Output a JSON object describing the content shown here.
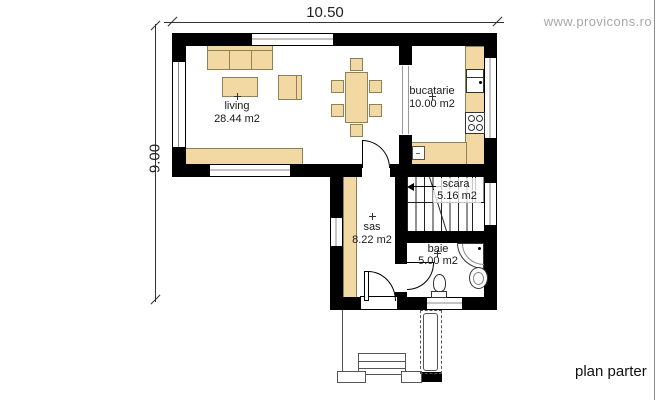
{
  "watermark": {
    "text": "www.provicons.ro"
  },
  "caption": "plan parter",
  "dimensions": {
    "width": "10.50",
    "height": "9.00"
  },
  "rooms": [
    {
      "id": "living",
      "name": "living",
      "area": "28.44 m2"
    },
    {
      "id": "bucatarie",
      "name": "bucatarie",
      "area": "10.00 m2"
    },
    {
      "id": "scara",
      "name": "scara",
      "area": "5.16 m2"
    },
    {
      "id": "sas",
      "name": "sas",
      "area": "8.22 m2"
    },
    {
      "id": "baie",
      "name": "baie",
      "area": "5.00 m2"
    }
  ],
  "colors": {
    "wall": "#000000",
    "furniture_fill": "#f2d8a2",
    "furniture_border": "#8d8157",
    "watermark": "#a8a8a8"
  }
}
